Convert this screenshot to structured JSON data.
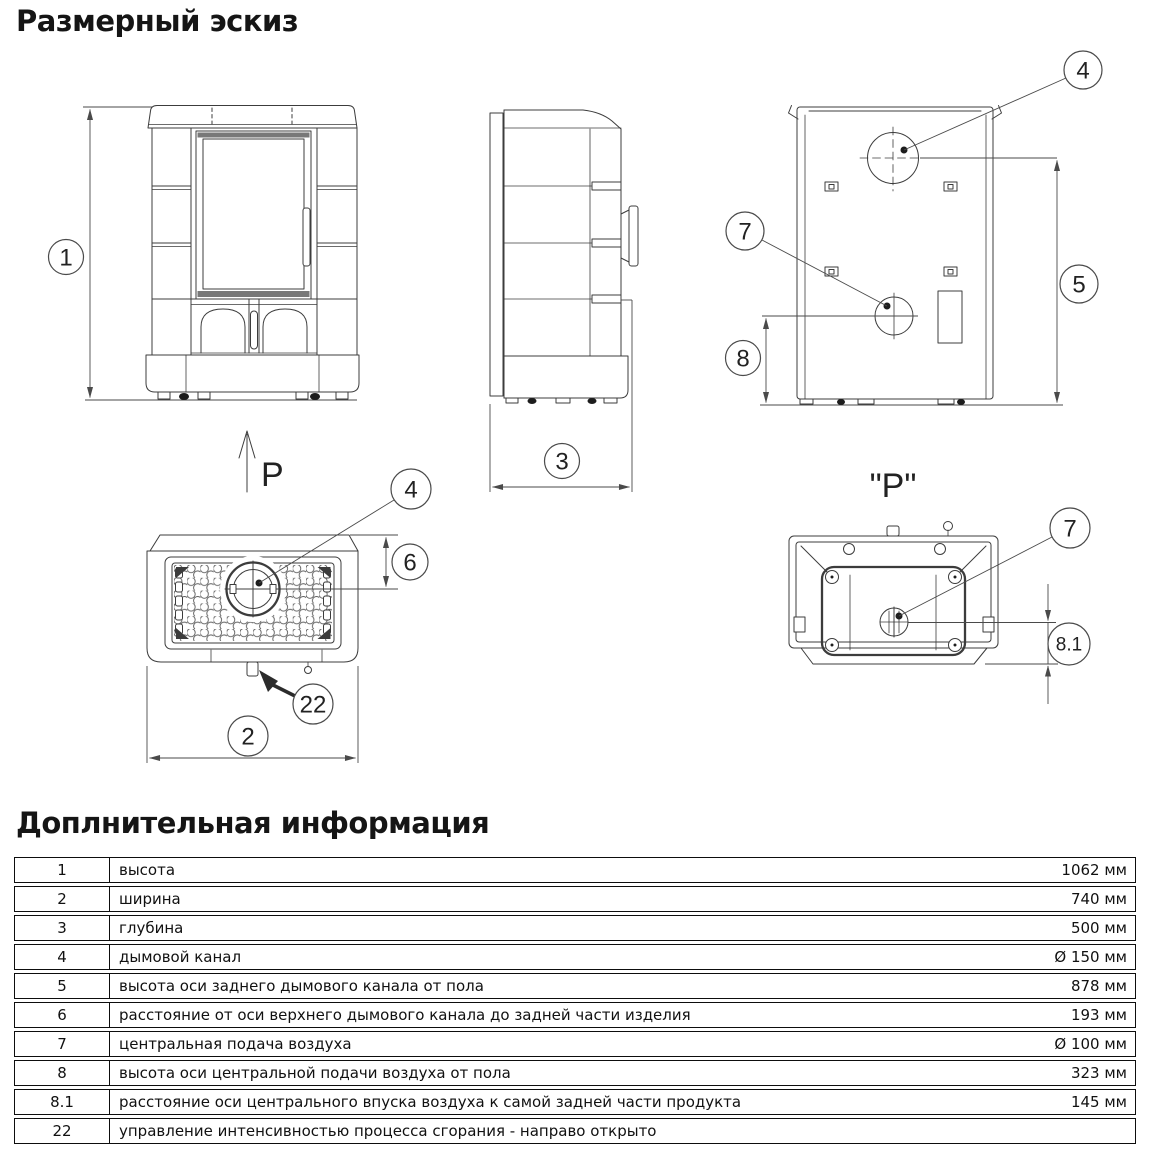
{
  "page": {
    "title": "Размерный эскиз",
    "info_title": "Доплнительная информация"
  },
  "drawing": {
    "balloons": {
      "n1": "1",
      "n2": "2",
      "n3": "3",
      "n4": "4",
      "n5": "5",
      "n6": "6",
      "n7": "7",
      "n8": "8",
      "n8_1": "8.1",
      "n22": "22"
    },
    "view_labels": {
      "p_arrow": "P",
      "p_view": "\"P\""
    }
  },
  "table": {
    "rows": [
      {
        "num": "1",
        "label": "высота",
        "value": "1062 мм"
      },
      {
        "num": "2",
        "label": "ширина",
        "value": "740 мм"
      },
      {
        "num": "3",
        "label": "глубина",
        "value": "500 мм"
      },
      {
        "num": "4",
        "label": "дымовой канал",
        "value": "Ø 150 мм"
      },
      {
        "num": "5",
        "label": "высота оси заднего дымового канала от пола",
        "value": "878 мм"
      },
      {
        "num": "6",
        "label": "расстояние от оси верхнего дымового канала до задней части изделия",
        "value": "193 мм"
      },
      {
        "num": "7",
        "label": "центральная подача воздуха",
        "value": "Ø 100 мм"
      },
      {
        "num": "8",
        "label": "высота оси центральной подачи воздуха от пола",
        "value": "323 мм"
      },
      {
        "num": "8.1",
        "label": "расстояние оси центрального впуска воздуха к самой задней части продукта",
        "value": "145 мм"
      },
      {
        "num": "22",
        "label": "управление интенсивностью процесса сгорания - направо открыто",
        "value": ""
      }
    ]
  }
}
